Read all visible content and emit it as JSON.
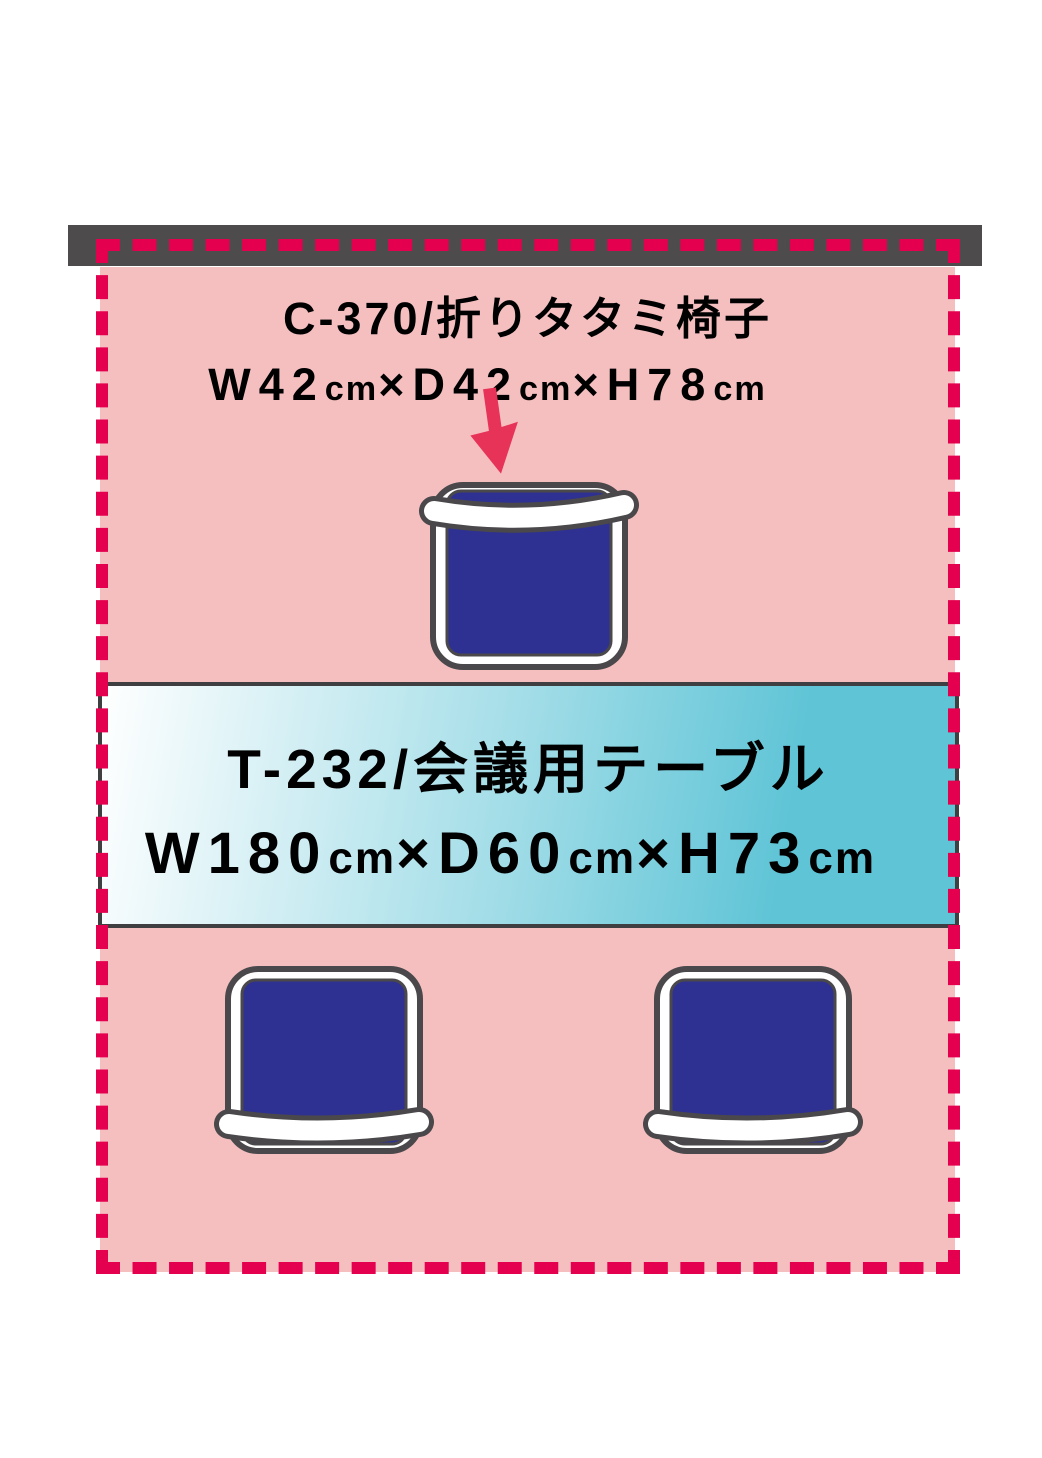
{
  "diagram": {
    "type": "furniture-layout",
    "colors": {
      "background": "#ffffff",
      "wall_bar": "#4d4b4c",
      "zone_fill": "#f5bfc0",
      "dash_border": "#e4004e",
      "arrow": "#e73358",
      "chair_frame_outline": "#4a484a",
      "chair_frame_fill": "#ffffff",
      "chair_seat_blue": "#2e3191",
      "table_border": "#3f3f41",
      "table_gradient_start": "#ffffff",
      "table_gradient_mid": "#a8dfe9",
      "table_gradient_end": "#5ec4d6",
      "text": "#000000"
    },
    "chair_callout": {
      "model": "C-370/折りタタミ椅子",
      "dims_text": "W42cm×D42cm×H78cm",
      "dims_segments": [
        {
          "text": "W42",
          "small": false
        },
        {
          "text": "cm",
          "small": true
        },
        {
          "text": "×",
          "small": false
        },
        {
          "text": "D42",
          "small": false
        },
        {
          "text": "cm",
          "small": true
        },
        {
          "text": "×",
          "small": false
        },
        {
          "text": "H78",
          "small": false
        },
        {
          "text": "cm",
          "small": true
        }
      ]
    },
    "table_label": {
      "model": "T-232/会議用テーブル",
      "dims_text": "W180cm×D60cm×H73cm",
      "dims_segments": [
        {
          "text": "W180",
          "small": false
        },
        {
          "text": "cm",
          "small": true
        },
        {
          "text": "×",
          "small": false
        },
        {
          "text": "D60",
          "small": false
        },
        {
          "text": "cm",
          "small": true
        },
        {
          "text": "×",
          "small": false
        },
        {
          "text": "H73",
          "small": false
        },
        {
          "text": "cm",
          "small": true
        }
      ]
    },
    "chairs": [
      "top",
      "bottom-left",
      "bottom-right"
    ]
  }
}
